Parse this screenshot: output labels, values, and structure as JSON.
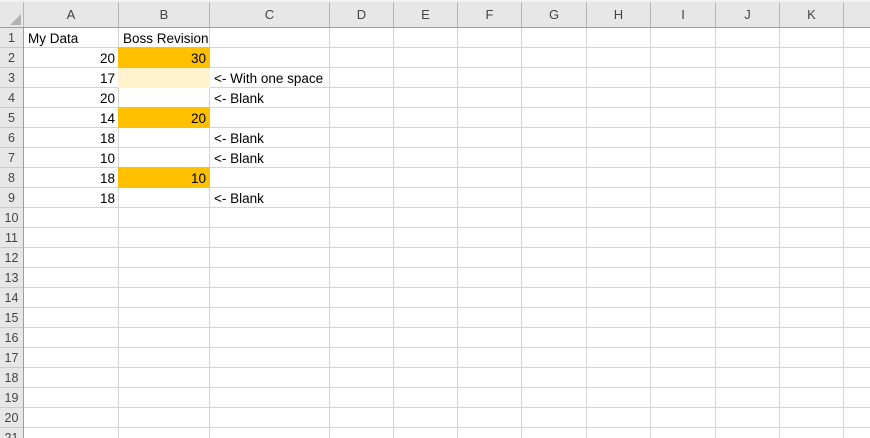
{
  "grid": {
    "column_letters": [
      "A",
      "B",
      "C",
      "D",
      "E",
      "F",
      "G",
      "H",
      "I",
      "J",
      "K"
    ],
    "row_numbers": [
      "1",
      "2",
      "3",
      "4",
      "5",
      "6",
      "7",
      "8",
      "9",
      "10",
      "11",
      "12",
      "13",
      "14",
      "15",
      "16",
      "17",
      "18",
      "19",
      "20",
      "21"
    ],
    "colors": {
      "highlight_strong": "#FFC000",
      "highlight_light": "#FFF2CC",
      "header_bg": "#E7E7E7",
      "gridline": "#D5D5D5",
      "header_border": "#9E9E9E",
      "cell_text": "#000000",
      "header_text": "#444444"
    },
    "cells": {
      "A1": "My Data",
      "B1": "Boss Revision",
      "A2": "20",
      "B2": "30",
      "A3": "17",
      "B3": " ",
      "C3": "<- With one space",
      "A4": "20",
      "C4": "<- Blank",
      "A5": "14",
      "B5": "20",
      "A6": "18",
      "C6": "<- Blank",
      "A7": "10",
      "C7": "<- Blank",
      "A8": "18",
      "B8": "10",
      "A9": "18",
      "C9": "<- Blank"
    }
  }
}
